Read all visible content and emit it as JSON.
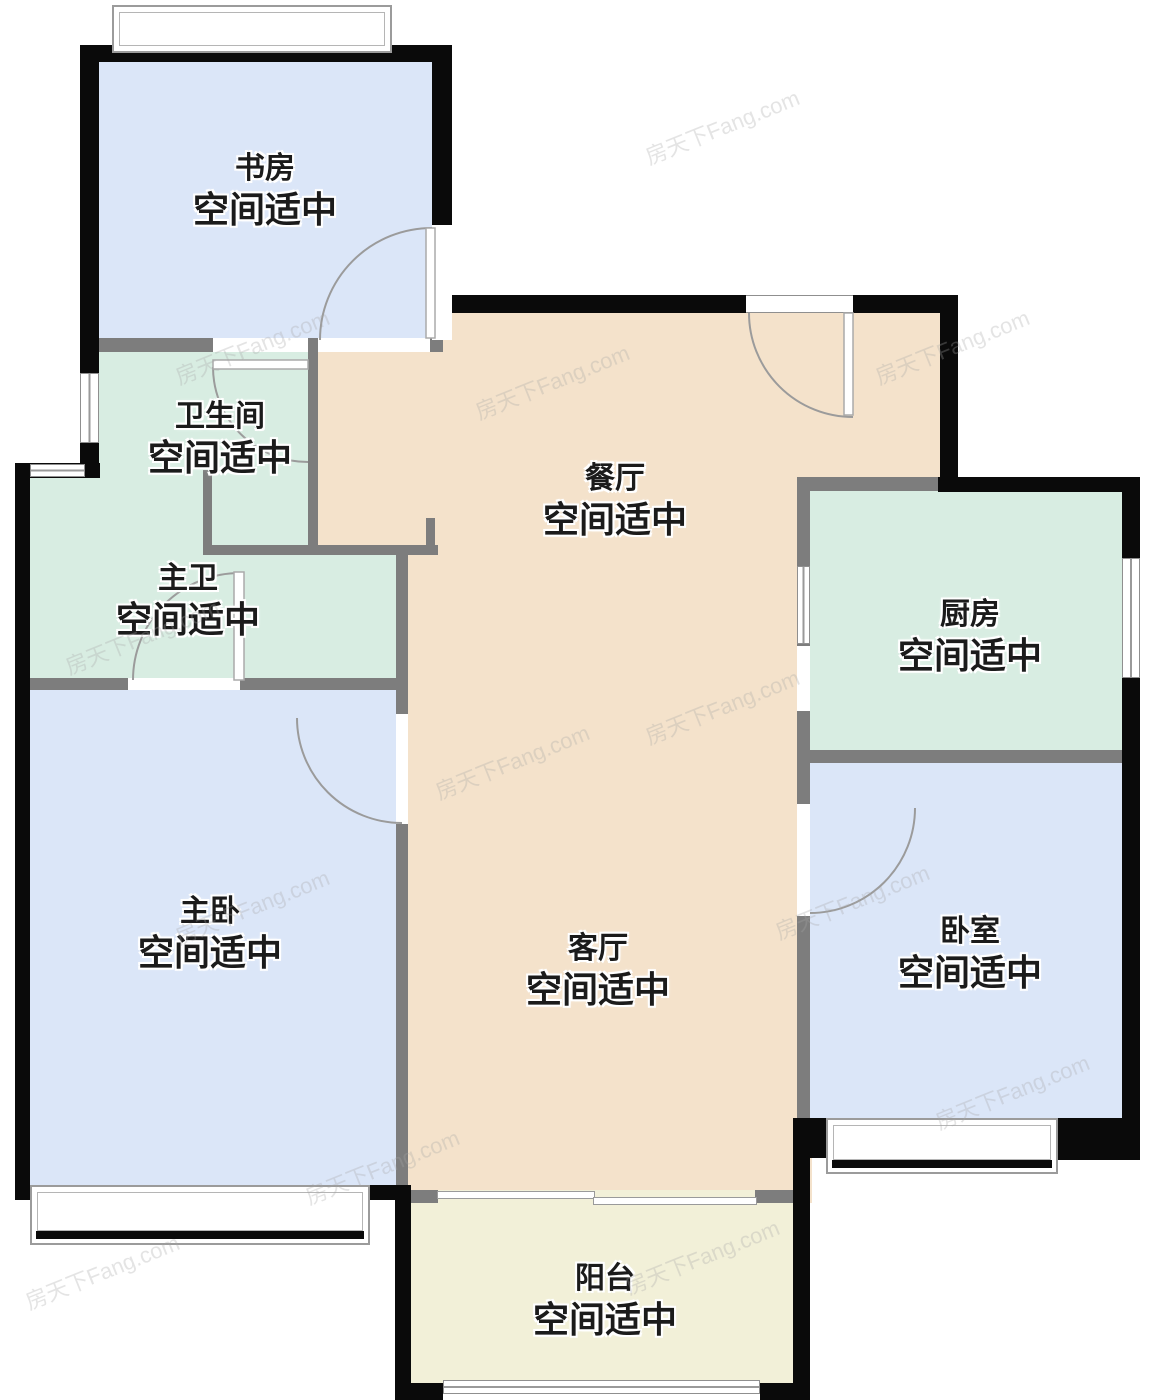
{
  "title": "户型图",
  "watermark": "房天下Fang.com",
  "palette": {
    "bedroom_blue": "#dbe6f8",
    "bath_kitchen_teal": "#d8ede2",
    "living_dining_tan": "#f4e2cb",
    "balcony_yellow": "#f2f0d8",
    "exterior_wall": "#0a0a0a",
    "interior_wall": "#7d7d7d"
  },
  "rooms": [
    {
      "id": "study",
      "name": "书房",
      "note": "空间适中"
    },
    {
      "id": "bathroom",
      "name": "卫生间",
      "note": "空间适中"
    },
    {
      "id": "master_bath",
      "name": "主卫",
      "note": "空间适中"
    },
    {
      "id": "dining",
      "name": "餐厅",
      "note": "空间适中"
    },
    {
      "id": "kitchen",
      "name": "厨房",
      "note": "空间适中"
    },
    {
      "id": "master_bedroom",
      "name": "主卧",
      "note": "空间适中"
    },
    {
      "id": "living",
      "name": "客厅",
      "note": "空间适中"
    },
    {
      "id": "bedroom",
      "name": "卧室",
      "note": "空间适中"
    },
    {
      "id": "balcony",
      "name": "阳台",
      "note": "空间适中"
    }
  ]
}
